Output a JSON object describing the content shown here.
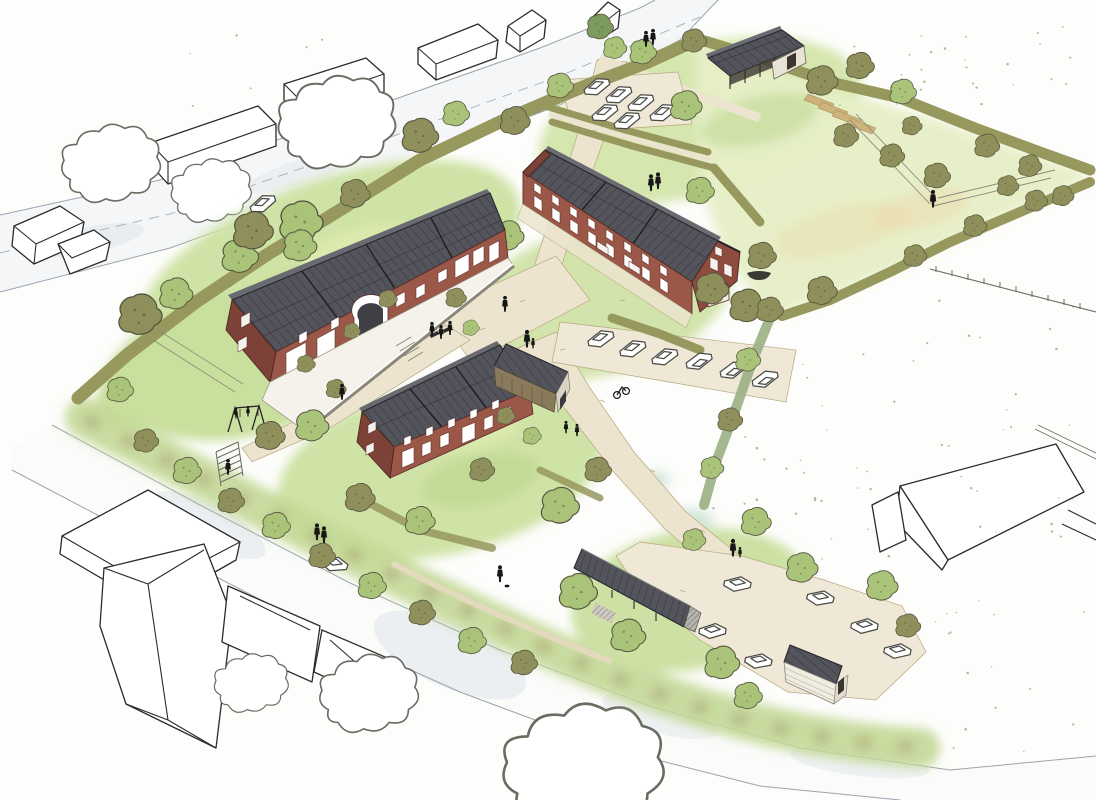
{
  "document": {
    "kind": "architectural aerial site sketch",
    "medium": "ink line and watercolor wash",
    "view": "bird's-eye perspective of a small housing scheme in open fields"
  },
  "site": {
    "buildings": [
      {
        "name": "west-terrace",
        "label": "long brick terrace, solar-panel roof, central arched passage, paved front courtyard with low wall"
      },
      {
        "name": "north-east-houses",
        "label": "stepped row of taller brick houses, solar-panel roof, south-east gable with arched garage door"
      },
      {
        "name": "south-terrace",
        "label": "two-storey brick terrace with solar-panel roof and attached timber barn"
      },
      {
        "name": "field-barn",
        "label": "open timber barn with panelled roof, north edge of site"
      },
      {
        "name": "bike-shed",
        "label": "long open shed with panelled roof by south parking court"
      },
      {
        "name": "garden-shed",
        "label": "small clapboard shed with panelled roof"
      }
    ],
    "landscape": [
      "meadow lawns",
      "orchard with fruit trees",
      "allotment beds",
      "double hedge lane",
      "hedgerow boundaries",
      "play lawn with swing set",
      "stepped footpath to road",
      "gravel lanes and central court",
      "three parking courts",
      "roadside embankment planting",
      "east paddock with post-and-rail fences",
      "rowboat on the grass"
    ],
    "figures": {
      "people": 22,
      "cyclists": 1,
      "cars": 20,
      "dogs": 1
    },
    "context": [
      "outlined neighbouring houses to the north-west",
      "outlined farmhouse cluster to the south-west",
      "outlined barn in the east paddock",
      "outlined trees on white paper",
      "two perimeter roads with dashed centreline"
    ]
  },
  "palette": {
    "paper": "#fdfdfb",
    "ink": "#2b2b2b",
    "outline": "#4a4a46",
    "green_wash": "#cfe3a6",
    "green_deep": "#b9d48a",
    "green_pale": "#e6eec6",
    "green_band": "#c3d896",
    "olive": "#8f8f5c",
    "olive_dark": "#6b6b40",
    "tree_green": "#a9c379",
    "tree_dark": "#7d9a5e",
    "hedge": "#97985e",
    "hedge_teal": "#9ab083",
    "brick": "#9b5748",
    "brick_dark": "#7c4237",
    "brick_end": "#8e4c3f",
    "roof": "#54545c",
    "roof_dark": "#26262c",
    "roof_light": "#6a6a72",
    "path": "#ece4cf",
    "path_edge": "#b7a87e",
    "lot": "#efe8d6",
    "road_wash": "#dce3e8",
    "road_edge": "#9aa5ad",
    "wall_white": "#f4f2ea",
    "timber": "#8a7a5c",
    "shed_wall": "#f0ece0",
    "barn_wall": "#e9e3d5",
    "figure": "#161616",
    "speck": "#6b6b5a",
    "soil": "#c8a468",
    "yellow_wash": "#e9efb6",
    "teal_wash": "#bcd8c6"
  },
  "scene": {
    "trees": [
      [
        140,
        315,
        1.3,
        "o",
        "f"
      ],
      [
        176,
        294,
        1.0,
        "g",
        "f"
      ],
      [
        240,
        256,
        1.1,
        "g",
        "b"
      ],
      [
        301,
        222,
        1.3,
        "g",
        "b"
      ],
      [
        355,
        194,
        0.9,
        "o",
        "b"
      ],
      [
        420,
        136,
        1.1,
        "o",
        "f"
      ],
      [
        456,
        114,
        0.8,
        "g",
        "f"
      ],
      [
        515,
        121,
        0.9,
        "o",
        "f"
      ],
      [
        560,
        86,
        0.8,
        "g",
        "f"
      ],
      [
        253,
        231,
        1.2,
        "o",
        "b"
      ],
      [
        300,
        246,
        1.0,
        "g",
        "b"
      ],
      [
        120,
        390,
        0.8,
        "g",
        "f"
      ],
      [
        270,
        436,
        0.9,
        "o",
        "f"
      ],
      [
        312,
        426,
        1.0,
        "g",
        "f"
      ],
      [
        388,
        299,
        0.55,
        "o",
        "f"
      ],
      [
        352,
        331,
        0.5,
        "o",
        "f"
      ],
      [
        306,
        364,
        0.55,
        "o",
        "f"
      ],
      [
        336,
        389,
        0.6,
        "o",
        "f"
      ],
      [
        456,
        298,
        0.62,
        "o",
        "f"
      ],
      [
        471,
        328,
        0.5,
        "g",
        "f"
      ],
      [
        508,
        236,
        0.95,
        "g",
        "b"
      ],
      [
        712,
        289,
        1.0,
        "o",
        "f"
      ],
      [
        747,
        306,
        1.05,
        "o",
        "f"
      ],
      [
        700,
        191,
        0.85,
        "g",
        "f"
      ],
      [
        600,
        27,
        0.8,
        "d",
        "f"
      ],
      [
        615,
        48,
        0.7,
        "g",
        "f"
      ],
      [
        643,
        52,
        0.8,
        "g",
        "f"
      ],
      [
        686,
        106,
        0.95,
        "g",
        "f"
      ],
      [
        694,
        41,
        0.75,
        "o",
        "f"
      ],
      [
        822,
        81,
        0.95,
        "o",
        "f"
      ],
      [
        860,
        66,
        0.85,
        "o",
        "f"
      ],
      [
        903,
        92,
        0.8,
        "g",
        "f"
      ],
      [
        846,
        136,
        0.75,
        "o",
        "f"
      ],
      [
        892,
        156,
        0.75,
        "o",
        "f"
      ],
      [
        937,
        176,
        0.8,
        "o",
        "f"
      ],
      [
        987,
        146,
        0.75,
        "o",
        "f"
      ],
      [
        1030,
        166,
        0.7,
        "o",
        "f"
      ],
      [
        1063,
        196,
        0.65,
        "o",
        "f"
      ],
      [
        1008,
        186,
        0.65,
        "o",
        "f"
      ],
      [
        912,
        126,
        0.6,
        "o",
        "f"
      ],
      [
        762,
        256,
        0.85,
        "o",
        "f"
      ],
      [
        822,
        291,
        0.9,
        "o",
        "f"
      ],
      [
        915,
        256,
        0.7,
        "o",
        "f"
      ],
      [
        975,
        226,
        0.7,
        "o",
        "f"
      ],
      [
        1036,
        201,
        0.68,
        "o",
        "f"
      ],
      [
        770,
        310,
        0.8,
        "o",
        "f"
      ],
      [
        748,
        360,
        0.75,
        "g",
        "f"
      ],
      [
        730,
        420,
        0.75,
        "o",
        "f"
      ],
      [
        712,
        468,
        0.7,
        "g",
        "f"
      ],
      [
        360,
        498,
        0.9,
        "o",
        "f"
      ],
      [
        420,
        521,
        0.9,
        "g",
        "f"
      ],
      [
        482,
        470,
        0.75,
        "o",
        "f"
      ],
      [
        560,
        506,
        1.15,
        "g",
        "f"
      ],
      [
        598,
        470,
        0.8,
        "o",
        "f"
      ],
      [
        506,
        416,
        0.55,
        "o",
        "f"
      ],
      [
        532,
        436,
        0.55,
        "g",
        "f"
      ],
      [
        146,
        441,
        0.75,
        "o",
        "f"
      ],
      [
        187,
        471,
        0.85,
        "g",
        "f"
      ],
      [
        231,
        501,
        0.8,
        "o",
        "f"
      ],
      [
        276,
        526,
        0.85,
        "g",
        "f"
      ],
      [
        322,
        556,
        0.8,
        "o",
        "f"
      ],
      [
        372,
        586,
        0.85,
        "g",
        "f"
      ],
      [
        422,
        613,
        0.8,
        "o",
        "f"
      ],
      [
        472,
        641,
        0.85,
        "g",
        "f"
      ],
      [
        524,
        663,
        0.8,
        "o",
        "f"
      ],
      [
        578,
        592,
        1.15,
        "g",
        "f"
      ],
      [
        628,
        636,
        1.05,
        "g",
        "f"
      ],
      [
        722,
        663,
        1.05,
        "g",
        "f"
      ],
      [
        748,
        696,
        0.85,
        "g",
        "f"
      ],
      [
        802,
        568,
        0.95,
        "g",
        "f"
      ],
      [
        882,
        586,
        0.95,
        "g",
        "f"
      ],
      [
        908,
        626,
        0.75,
        "o",
        "f"
      ],
      [
        756,
        522,
        0.9,
        "g",
        "f"
      ],
      [
        694,
        540,
        0.7,
        "g",
        "f"
      ]
    ],
    "outline_trees": [
      [
        112,
        170,
        1.6
      ],
      [
        212,
        196,
        1.3
      ],
      [
        338,
        130,
        1.9
      ],
      [
        585,
        778,
        2.6
      ],
      [
        370,
        700,
        1.6
      ],
      [
        252,
        688,
        1.2
      ]
    ],
    "cars": [
      [
        596,
        86,
        -15
      ],
      [
        618,
        94,
        -15
      ],
      [
        640,
        102,
        -15
      ],
      [
        604,
        112,
        -15
      ],
      [
        626,
        120,
        -15
      ],
      [
        662,
        112,
        -15
      ],
      [
        600,
        338,
        -12
      ],
      [
        632,
        348,
        -12
      ],
      [
        664,
        356,
        -12
      ],
      [
        700,
        362,
        168
      ],
      [
        734,
        371,
        168
      ],
      [
        766,
        380,
        168
      ],
      [
        737,
        583,
        12
      ],
      [
        820,
        597,
        15
      ],
      [
        712,
        630,
        8
      ],
      [
        758,
        660,
        14
      ],
      [
        864,
        625,
        10
      ],
      [
        897,
        650,
        12
      ],
      [
        262,
        203,
        -17
      ],
      [
        334,
        563,
        20
      ]
    ],
    "people": [
      [
        432,
        330,
        0.8
      ],
      [
        441,
        333,
        0.8
      ],
      [
        450,
        329,
        0.8
      ],
      [
        505,
        305,
        0.9
      ],
      [
        527,
        340,
        1.0
      ],
      [
        533,
        344,
        0.6
      ],
      [
        342,
        393,
        0.9
      ],
      [
        651,
        184,
        0.95
      ],
      [
        658,
        182,
        0.95
      ],
      [
        646,
        40,
        0.9
      ],
      [
        653,
        38,
        0.9
      ],
      [
        566,
        428,
        0.7
      ],
      [
        577,
        431,
        0.7
      ],
      [
        733,
        549,
        1.0
      ],
      [
        740,
        553,
        0.6
      ],
      [
        500,
        575,
        0.95
      ],
      [
        317,
        533,
        0.95
      ],
      [
        324,
        536,
        0.95
      ],
      [
        933,
        200,
        1.0
      ],
      [
        228,
        468,
        0.9
      ],
      [
        236,
        414,
        0.6
      ],
      [
        248,
        412,
        0.6
      ]
    ]
  }
}
